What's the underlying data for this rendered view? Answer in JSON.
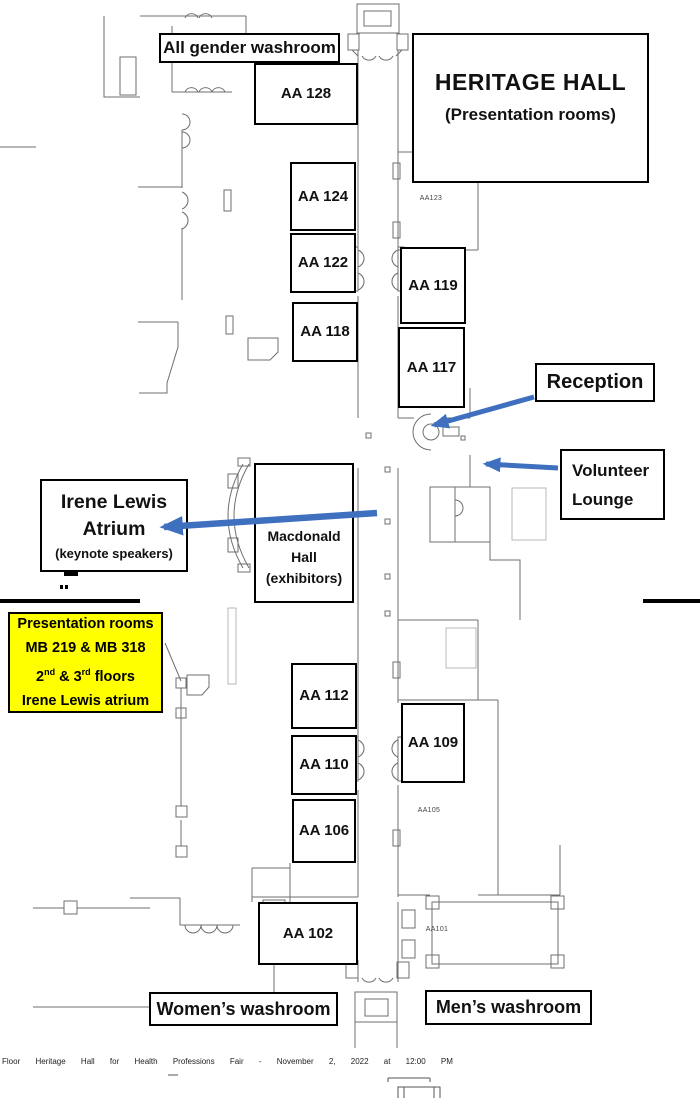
{
  "title_box": {
    "line1": "HERITAGE HALL",
    "line2": "(Presentation rooms)"
  },
  "rooms": [
    "AA 128",
    "AA 124",
    "AA 122",
    "AA 118",
    "AA 119",
    "AA 117",
    "AA 112",
    "AA 110",
    "AA 106",
    "AA 109",
    "AA 102"
  ],
  "signs": {
    "all_gender_washroom": "All gender washroom",
    "womens_washroom": "Women’s washroom",
    "mens_washroom": "Men’s washroom",
    "reception": "Reception",
    "volunteer_lounge": {
      "line1": "Volunteer",
      "line2": "Lounge"
    },
    "irene_lewis": {
      "line1": "Irene Lewis",
      "line2": "Atrium",
      "line3": "(keynote speakers)"
    },
    "macdonald_hall": {
      "line1": "Macdonald",
      "line2": "Hall",
      "line3": "(exhibitors)"
    }
  },
  "yellow_note": {
    "line1": "Presentation rooms",
    "line2": "MB 219 & MB 318",
    "line3": {
      "t1": "2",
      "s1": "nd",
      "t2": " & 3",
      "s2": "rd",
      "t3": " floors"
    },
    "line4": "Irene Lewis atrium"
  },
  "plan_texts": {
    "aa123": "AA123",
    "aa105": "AA105",
    "aa101": "AA101"
  },
  "footer": "Floor Heritage Hall for Health Professions Fair - November 2, 2022 at 12:00 PM",
  "colors": {
    "arrow_blue": "#3f6fbf",
    "highlight_yellow": "#ffff00",
    "plan_line": "#6f6f6f",
    "section_break": "#000000"
  }
}
